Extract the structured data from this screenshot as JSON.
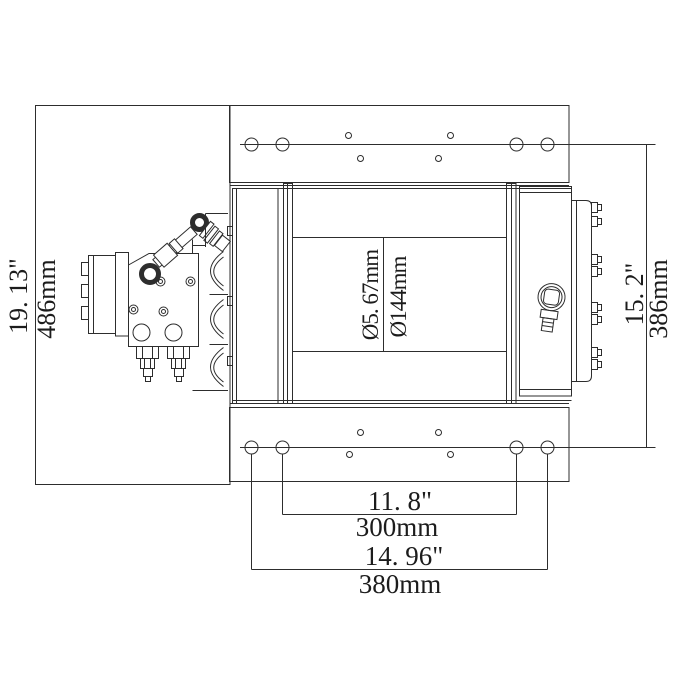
{
  "style": {
    "background": "#ffffff",
    "line_color": "#2d2d2d",
    "text_color": "#1c1c1c"
  },
  "labels": {
    "overall": {
      "inch": "19. 13\"",
      "mm": "486mm"
    },
    "mount_side": {
      "inch": "15. 2\"",
      "mm": "386mm"
    },
    "drum": {
      "inner_diameter": "Ø5. 67mm",
      "outer_diameter": "Ø144mm"
    },
    "hole_span_inner": {
      "inch": "11. 8\"",
      "mm": "300mm"
    },
    "hole_span_outer": {
      "inch": "14. 96\"",
      "mm": "380mm"
    }
  }
}
